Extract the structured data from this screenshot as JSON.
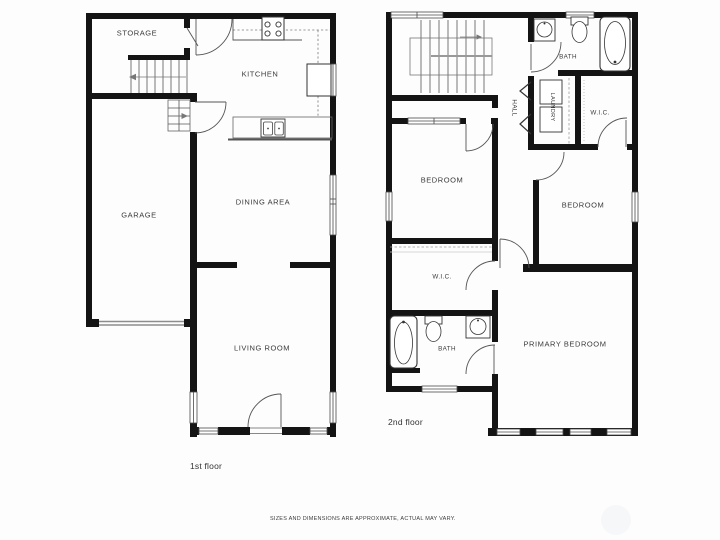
{
  "page": {
    "background": "#fdfdfe",
    "wall_color": "#141414",
    "thin_line_color": "#555555",
    "footer_disclaimer": "SIZES AND DIMENSIONS ARE APPROXIMATE, ACTUAL MAY VARY."
  },
  "floor1": {
    "caption": "1st floor",
    "labels": {
      "storage": "STORAGE",
      "kitchen": "KITCHEN",
      "garage": "GARAGE",
      "dining": "DINING AREA",
      "living": "LIVING ROOM"
    }
  },
  "floor2": {
    "caption": "2nd floor",
    "labels": {
      "bath_top": "BATH",
      "hall": "HALL",
      "laundry": "LAUNDRY",
      "wic_top": "W.I.C.",
      "bedroom_left": "BEDROOM",
      "bedroom_right": "BEDROOM",
      "wic_mid": "W.I.C.",
      "bath_bottom": "BATH",
      "primary_bedroom": "PRIMARY BEDROOM"
    }
  }
}
